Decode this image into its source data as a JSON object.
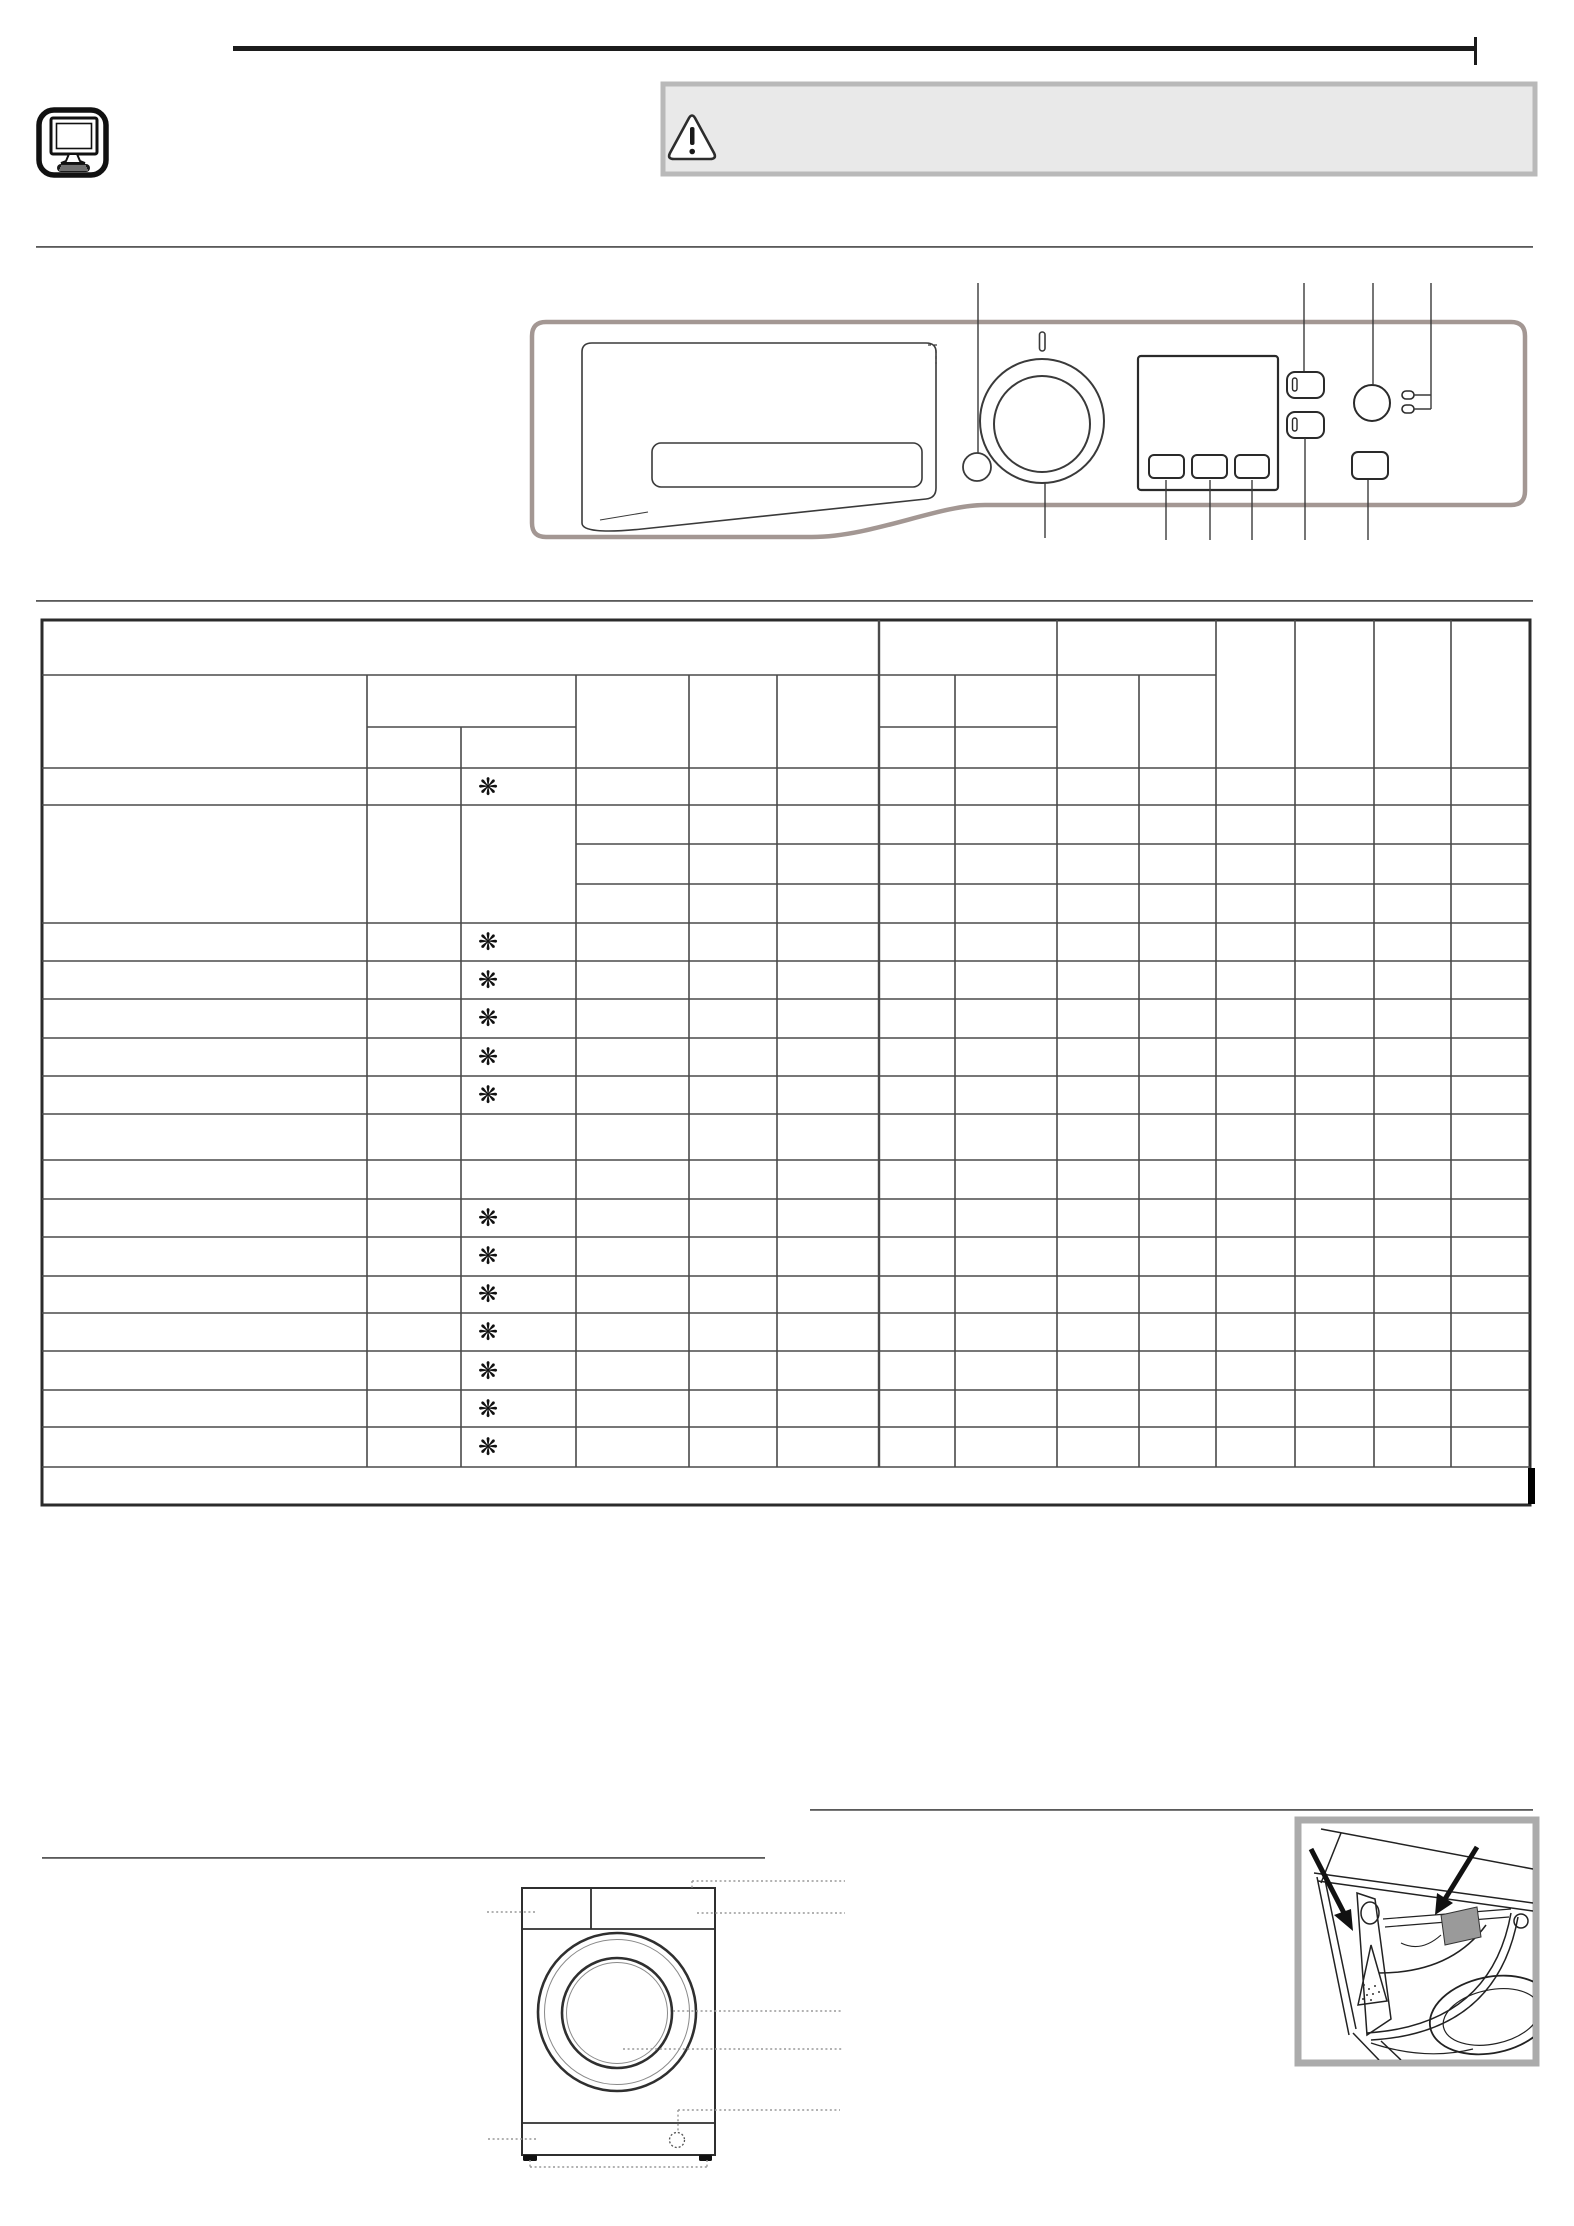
{
  "page": {
    "background": "#ffffff",
    "width_px": 1574,
    "height_px": 2226
  },
  "header": {
    "top_rule_color": "#1c1c1c",
    "computer_icon": "computer-icon",
    "warning_box": {
      "fill": "#e9e9e9",
      "border": "#b9b9b9",
      "icon": "warning-triangle-icon"
    }
  },
  "control_panel_diagram": {
    "outline_color": "#a39793",
    "line_color": "#3a3a3a",
    "parts": [
      "detergent-drawer",
      "on-off-indicator",
      "program-knob",
      "small-round-button",
      "display-screen",
      "display-button-1",
      "display-button-2",
      "display-button-3",
      "option-button-1",
      "option-button-2",
      "round-button",
      "led-indicator-1",
      "led-indicator-2",
      "start-pause-button"
    ],
    "callout_count": 10
  },
  "program_table": {
    "marker_symbol": "❋",
    "marker_color": "#111111",
    "marker_count": 13,
    "column_count": 14,
    "body_row_count": 17,
    "has_note_row": true,
    "grid_color": "#4a4a4a",
    "border_color": "#2b2b2b",
    "note_row_end_bar_color": "#000000"
  },
  "washer_front_diagram": {
    "parts": [
      "detergent-drawer-area",
      "control-panel-area",
      "porthole-door",
      "kick-strip",
      "drain-filter-cap",
      "feet"
    ],
    "callout_style": "dotted",
    "callout_color": "#999999"
  },
  "detergent_drawer_figure": {
    "frame_color": "#ababab",
    "arrow_color": "#111111",
    "shaded_slot_color": "#9a9a9a",
    "parts": [
      "siphon",
      "detergent-slot",
      "drawer-fan",
      "drum-opening"
    ]
  }
}
